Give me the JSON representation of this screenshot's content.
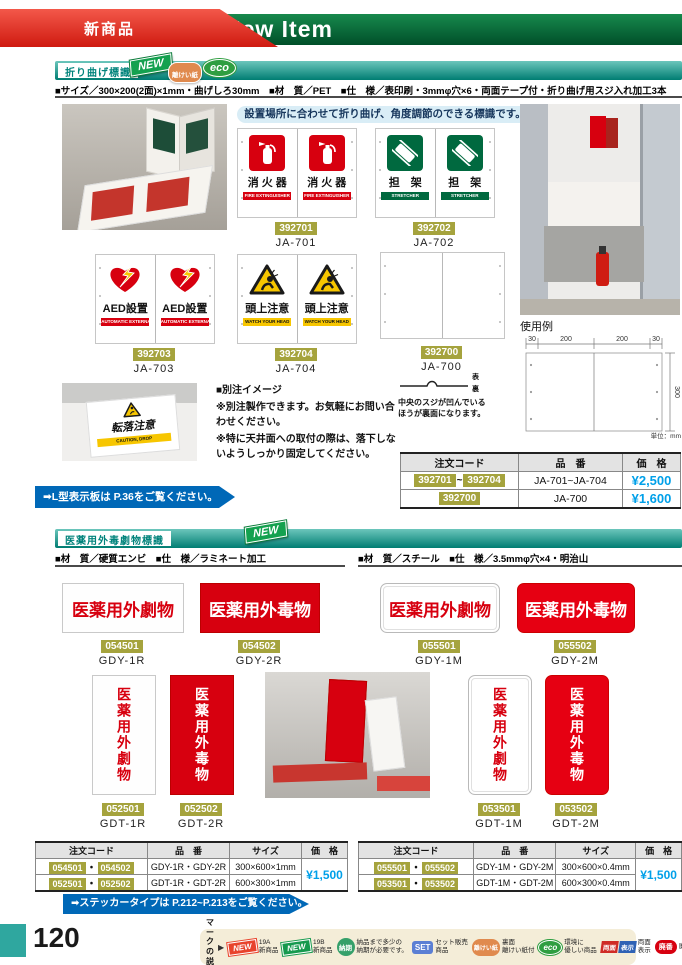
{
  "header": {
    "ribbon": "新商品",
    "title_prefix": "19",
    "title_circle": "B",
    "title_suffix": "New Item"
  },
  "section1": {
    "title": "折り曲げ標識",
    "badge_new": "NEW",
    "badge_release": "離けい紙",
    "badge_eco": "eco",
    "specs": "■サイズ／300×200(2面)×1mm・曲げしろ30mm　■材　質／PET　■仕　様／表印刷・3mmφ穴×6・両面テープ付・折り曲げ用スジ入れ加工3本",
    "banner": "設置場所に合わせて折り曲げ、角度調節のできる標識です。",
    "products": [
      {
        "code": "392701",
        "model": "JA-701",
        "label": "消 火 器",
        "band": "FIRE EXTINGUISHER"
      },
      {
        "code": "392702",
        "model": "JA-702",
        "label": "担　架",
        "band": "STRETCHER"
      },
      {
        "code": "392703",
        "model": "JA-703",
        "label": "AED設置",
        "band": "AUTOMATIC EXTERNAL DEFIBRILLATOR"
      },
      {
        "code": "392704",
        "model": "JA-704",
        "label": "頭上注意",
        "band": "WATCH YOUR HEAD"
      },
      {
        "code": "392700",
        "model": "JA-700",
        "label": "",
        "band": ""
      }
    ],
    "usage_label": "使用例",
    "diagram": {
      "d1": "30",
      "d2": "200",
      "d3": "200",
      "d4": "30",
      "side": "300",
      "unit": "単位：mm"
    },
    "fold_front": "表",
    "fold_back": "裏",
    "fold_text": "中央のスジが凹んでいるほうが裏面になります。",
    "note_title": "■別注イメージ",
    "note_line1": "※別注製作できます。お気軽にお問い合わせください。",
    "note_line2": "※特に天井面への取付の際は、落下しないようしっかり固定してください。",
    "custom_label": "転落注意",
    "custom_band": "CAUTION, DROP",
    "link": "➡L型表示板は P.36をご覧ください。",
    "table": {
      "h_code": "注文コード",
      "h_model": "品　番",
      "h_price": "価　格",
      "r1_code1": "392701",
      "r1_sep": "~",
      "r1_code2": "392704",
      "r1_model": "JA-701~JA-704",
      "r1_price": "¥2,500",
      "r2_code": "392700",
      "r2_model": "JA-700",
      "r2_price": "¥1,600"
    }
  },
  "section2": {
    "title": "医薬用外毒劇物標識",
    "badge_new": "NEW",
    "specs_left": "■材　質／硬質エンビ　■仕　様／ラミネート加工",
    "specs_right": "■材　質／スチール　■仕　様／3.5mmφ穴×4・明治山",
    "products_h": [
      {
        "code": "054501",
        "model": "GDY-1R",
        "label": "医薬用外劇物"
      },
      {
        "code": "054502",
        "model": "GDY-2R",
        "label": "医薬用外毒物"
      },
      {
        "code": "055501",
        "model": "GDY-1M",
        "label": "医薬用外劇物"
      },
      {
        "code": "055502",
        "model": "GDY-2M",
        "label": "医薬用外毒物"
      }
    ],
    "products_v": [
      {
        "code": "052501",
        "model": "GDT-1R",
        "label": "医薬用外劇物"
      },
      {
        "code": "052502",
        "model": "GDT-2R",
        "label": "医薬用外毒物"
      },
      {
        "code": "053501",
        "model": "GDT-1M",
        "label": "医薬用外劇物"
      },
      {
        "code": "053502",
        "model": "GDT-2M",
        "label": "医薬用外毒物"
      }
    ],
    "table_left": {
      "h_code": "注文コード",
      "h_model": "品　番",
      "h_size": "サイズ",
      "h_price": "価　格",
      "sep": "・",
      "r1_code1": "054501",
      "r1_code2": "054502",
      "r1_model": "GDY-1R・GDY-2R",
      "r1_size": "300×600×1mm",
      "r2_code1": "052501",
      "r2_code2": "052502",
      "r2_model": "GDT-1R・GDT-2R",
      "r2_size": "600×300×1mm",
      "price": "¥1,500"
    },
    "table_right": {
      "h_code": "注文コード",
      "h_model": "品　番",
      "h_size": "サイズ",
      "h_price": "価　格",
      "sep": "・",
      "r1_code1": "055501",
      "r1_code2": "055502",
      "r1_model": "GDY-1M・GDY-2M",
      "r1_size": "300×600×0.4mm",
      "r2_code1": "053501",
      "r2_code2": "053502",
      "r2_model": "GDT-1M・GDT-2M",
      "r2_size": "600×300×0.4mm",
      "price": "¥1,500"
    },
    "link": "➡ステッカータイプは P.212~P.213をご覧ください。"
  },
  "footer": {
    "page_number": "120",
    "legend_title": "マークの\n説明",
    "legend_arrow": "▶",
    "items": [
      {
        "badge": "NEW",
        "text": "19A\n新商品"
      },
      {
        "badge": "NEW",
        "text": "19B\n新商品"
      },
      {
        "badge": "納期",
        "text": "納品まで多少の\n納期が必要です。"
      },
      {
        "badge": "SET",
        "text": "セット販売\n商品"
      },
      {
        "badge": "離けい紙",
        "text": "裏面\n離けい紙付"
      },
      {
        "badge": "eco",
        "text": "環境に\n優しい商品"
      },
      {
        "badge_a": "両面",
        "badge_b": "表示",
        "text": "両面\n表示"
      },
      {
        "badge": "廃番",
        "text": "廃番商品"
      }
    ]
  }
}
